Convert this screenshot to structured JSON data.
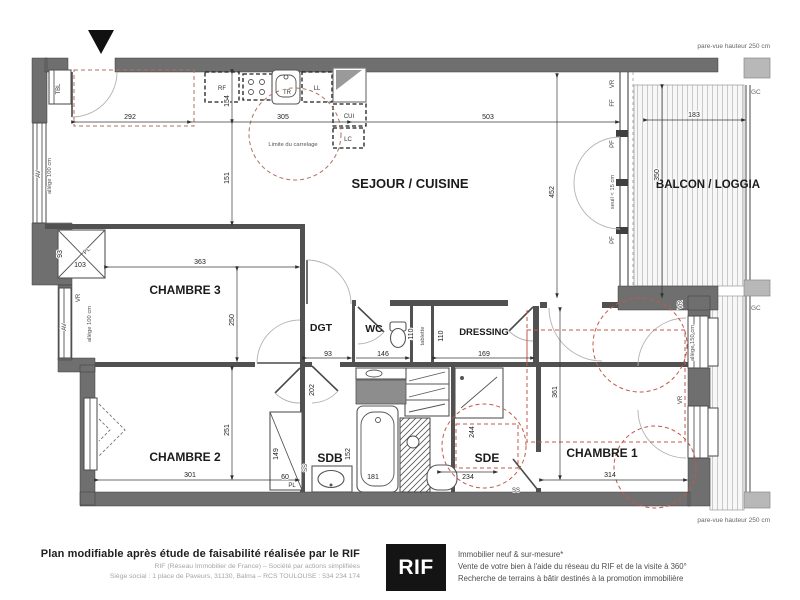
{
  "rooms": {
    "sejour_cuisine": "SEJOUR / CUISINE",
    "balcon_loggia": "BALCON / LOGGIA",
    "chambre1": "CHAMBRE 1",
    "chambre2": "CHAMBRE 2",
    "chambre3": "CHAMBRE 3",
    "dgt": "DGT",
    "wc": "WC",
    "dressing": "DRESSING",
    "sdb": "SDB",
    "sde": "SDE"
  },
  "tags": {
    "rf": "RF",
    "tr": "TR",
    "ll": "LL",
    "cui": "CUI",
    "lc": "LC",
    "pl": "PL",
    "av": "AV",
    "tbl": "TBL",
    "vr": "VR",
    "ff": "FF",
    "pf": "PF",
    "ss": "SS",
    "gc": "GC"
  },
  "annotations": {
    "limite_carrelage": "Limite du carrelage",
    "tablette": "tablette",
    "allege_100": "allège 100 cm",
    "allege_150": "allège 150 cm",
    "seuil_15": "seuil < 15 cm",
    "pare_vue": "pare-vue hauteur 250 cm"
  },
  "dimensions": {
    "entry_width": "292",
    "kitchen_width": "305",
    "sejour_width": "503",
    "balcon_width": "183",
    "balcon_depth": "350",
    "kitchen_depth_a": "154",
    "kitchen_depth_b": "151",
    "sejour_depth": "452",
    "ch3_width": "363",
    "ch3_depth": "250",
    "ch3_pl_depth": "93",
    "ch3_pl_width": "103",
    "dgt_width": "93",
    "dgt_depth": "202",
    "wc_width": "146",
    "wc_depth": "110",
    "niche_depth": "110",
    "dressing_width": "169",
    "ch2_width": "301",
    "ch2_depth": "251",
    "ch2_pl_height": "149",
    "ch2_pl_width": "60",
    "sdb_width": "152",
    "bath_length": "181",
    "sde_width": "234",
    "sde_depth": "244",
    "ch1_width": "314",
    "ch1_depth": "361"
  },
  "footer": {
    "title": "Plan modifiable après étude de faisabilité réalisée par le RIF",
    "company_line": "RIF (Réseau Immobilier de France) – Société par actions simplifiées",
    "address_line": "Siège social : 1 place de Paveurs, 31130, Balma – RCS TOULOUSE : 534 234 174",
    "logo": "RIF",
    "tagline1": "Immobilier neuf & sur-mesure*",
    "tagline2": "Vente de votre bien à l'aide du réseau du RIF et de la visite à 360°",
    "tagline3": "Recherche de terrains à bâtir destinés à la promotion immobilière"
  }
}
